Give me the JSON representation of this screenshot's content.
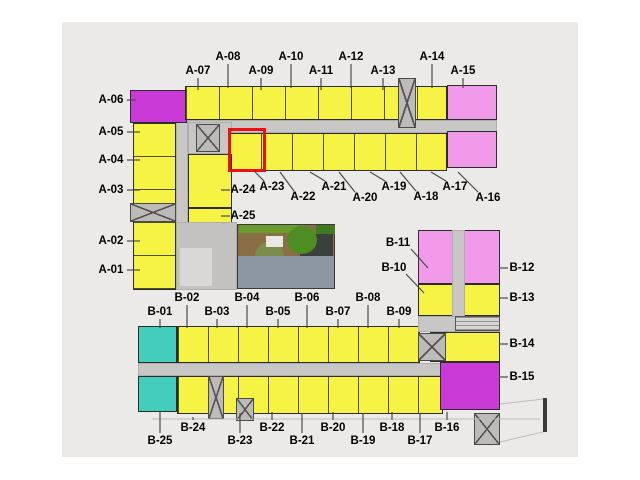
{
  "plan": {
    "selected_unit": "A-23",
    "colors": {
      "yellow": "#f6f344",
      "pink": "#f19ae9",
      "magenta": "#ca3ad6",
      "teal": "#43cdbd",
      "corridor": "#c8c7c5",
      "core": "#bcbbb9",
      "lobby": "#c3c2c0",
      "lobbyLight": "#d9d8d6",
      "service": "#d6d5d3",
      "wallbar": "#3a3a3a",
      "paper": "#ebeae8",
      "highlight": "#ec1111",
      "leader": "#4a4a4a",
      "outline": "#bdbcba",
      "deck": "#8a6e45",
      "green1": "#6a9c2e",
      "green2": "#3f7a1f",
      "tree": "#4e8d21",
      "bush": "#7b8c4d",
      "pavilion": "#3c403c",
      "white": "#e8e8e4",
      "pool": "#8c97a1"
    },
    "blocks": [
      {
        "name": "corridor-a-horizontal",
        "x": 176,
        "y": 120,
        "w": 321,
        "h": 13,
        "color": "corridor",
        "kind": "corridor"
      },
      {
        "name": "corridor-a-vertical",
        "x": 176,
        "y": 120,
        "w": 12,
        "h": 170,
        "color": "corridor",
        "kind": "corridor"
      },
      {
        "name": "entry-core-area",
        "x": 188,
        "y": 122,
        "w": 44,
        "h": 32,
        "color": "corridor",
        "kind": "corridor"
      },
      {
        "name": "unit-block-a06",
        "x": 130,
        "y": 90,
        "w": 57,
        "h": 33,
        "color": "magenta",
        "kind": "unit"
      },
      {
        "name": "unit-column-a05-a01",
        "x": 133,
        "y": 123,
        "w": 43,
        "h": 167,
        "color": "yellow",
        "kind": "unit",
        "tick": "h33"
      },
      {
        "name": "unit-row-a07-a14",
        "x": 185,
        "y": 86,
        "w": 262,
        "h": 34,
        "color": "yellow",
        "kind": "unit",
        "tick": "v33"
      },
      {
        "name": "unit-block-a15",
        "x": 447,
        "y": 85,
        "w": 50,
        "h": 35,
        "color": "pink",
        "kind": "unit"
      },
      {
        "name": "unit-row-a23-a17",
        "x": 229,
        "y": 133,
        "w": 218,
        "h": 38,
        "color": "yellow",
        "kind": "unit",
        "tick": "v31"
      },
      {
        "name": "unit-block-a16",
        "x": 447,
        "y": 131,
        "w": 50,
        "h": 37,
        "color": "pink",
        "kind": "unit"
      },
      {
        "name": "unit-block-a24",
        "x": 188,
        "y": 154,
        "w": 44,
        "h": 54,
        "color": "yellow",
        "kind": "unit"
      },
      {
        "name": "unit-block-a25",
        "x": 188,
        "y": 208,
        "w": 44,
        "h": 44,
        "color": "yellow",
        "kind": "unit"
      },
      {
        "name": "elevator-core-a",
        "x": 196,
        "y": 124,
        "w": 24,
        "h": 28,
        "color": "core",
        "kind": "core"
      },
      {
        "name": "stair-core-top",
        "x": 398,
        "y": 78,
        "w": 18,
        "h": 50,
        "color": "core",
        "kind": "core"
      },
      {
        "name": "stair-core-left",
        "x": 130,
        "y": 203,
        "w": 46,
        "h": 19,
        "color": "core",
        "kind": "core"
      },
      {
        "name": "lobby-area",
        "x": 176,
        "y": 222,
        "w": 61,
        "h": 68,
        "color": "lobby",
        "kind": "corridor"
      },
      {
        "name": "lobby-inner",
        "x": 180,
        "y": 248,
        "w": 32,
        "h": 38,
        "color": "lobbyLight",
        "kind": "decor"
      },
      {
        "name": "unit-block-b01",
        "x": 138,
        "y": 326,
        "w": 39,
        "h": 37,
        "color": "teal",
        "kind": "unit"
      },
      {
        "name": "unit-row-b02-b09",
        "x": 177,
        "y": 326,
        "w": 243,
        "h": 37,
        "color": "yellow",
        "kind": "unit",
        "tick": "v30"
      },
      {
        "name": "corridor-b-horizontal",
        "x": 138,
        "y": 363,
        "w": 327,
        "h": 13,
        "color": "corridor",
        "kind": "corridor"
      },
      {
        "name": "unit-block-b25",
        "x": 138,
        "y": 376,
        "w": 39,
        "h": 36,
        "color": "teal",
        "kind": "unit"
      },
      {
        "name": "unit-row-b24-b16",
        "x": 177,
        "y": 376,
        "w": 266,
        "h": 38,
        "color": "yellow",
        "kind": "unit",
        "tick": "v30"
      },
      {
        "name": "stair-core-b-left",
        "x": 208,
        "y": 376,
        "w": 16,
        "h": 43,
        "color": "core",
        "kind": "core"
      },
      {
        "name": "stair-core-b-mid",
        "x": 236,
        "y": 398,
        "w": 18,
        "h": 23,
        "color": "core",
        "kind": "core"
      },
      {
        "name": "unit-block-b11-b12",
        "x": 418,
        "y": 230,
        "w": 82,
        "h": 54,
        "color": "pink",
        "kind": "unit"
      },
      {
        "name": "unit-block-b10-b13",
        "x": 418,
        "y": 284,
        "w": 82,
        "h": 32,
        "color": "yellow",
        "kind": "unit"
      },
      {
        "name": "corridor-b-vertical",
        "x": 452,
        "y": 230,
        "w": 13,
        "h": 102,
        "color": "corridor",
        "kind": "corridor"
      },
      {
        "name": "corridor-b-right",
        "x": 418,
        "y": 316,
        "w": 82,
        "h": 16,
        "color": "corridor",
        "kind": "corridor"
      },
      {
        "name": "service-room-box",
        "x": 455,
        "y": 316,
        "w": 45,
        "h": 15,
        "color": "service",
        "kind": "service"
      },
      {
        "name": "unit-block-b14",
        "x": 430,
        "y": 332,
        "w": 70,
        "h": 30,
        "color": "yellow",
        "kind": "unit"
      },
      {
        "name": "elevator-core-b",
        "x": 418,
        "y": 333,
        "w": 28,
        "h": 28,
        "color": "core",
        "kind": "core"
      },
      {
        "name": "unit-block-b15",
        "x": 440,
        "y": 362,
        "w": 60,
        "h": 48,
        "color": "magenta",
        "kind": "unit"
      },
      {
        "name": "stair-core-bottom-right",
        "x": 474,
        "y": 413,
        "w": 26,
        "h": 32,
        "color": "core",
        "kind": "core"
      },
      {
        "name": "site-wall-bar",
        "x": 543,
        "y": 398,
        "w": 4,
        "h": 34,
        "color": "wallbar",
        "kind": "decor"
      }
    ],
    "courtyard": {
      "elements": [
        {
          "name": "courtyard-deck",
          "x": 237,
          "y": 224,
          "w": 98,
          "h": 65,
          "color": "deck",
          "border": true
        },
        {
          "name": "hedge-strip",
          "x": 239,
          "y": 225,
          "w": 60,
          "h": 8,
          "color": "green1"
        },
        {
          "name": "hedge-strip-2",
          "x": 316,
          "y": 225,
          "w": 19,
          "h": 10,
          "color": "green2"
        },
        {
          "name": "pool-pavilion",
          "x": 300,
          "y": 234,
          "w": 33,
          "h": 24,
          "color": "pavilion"
        },
        {
          "name": "courtyard-tree",
          "x": 287,
          "y": 226,
          "w": 30,
          "h": 28,
          "color": "tree",
          "round": true
        },
        {
          "name": "courtyard-bush",
          "x": 255,
          "y": 242,
          "w": 29,
          "h": 27,
          "color": "bush",
          "round": true
        },
        {
          "name": "pool-lounger",
          "x": 266,
          "y": 236,
          "w": 17,
          "h": 11,
          "color": "white"
        },
        {
          "name": "swimming-pool",
          "x": 238,
          "y": 256,
          "w": 96,
          "h": 32,
          "color": "pool"
        }
      ]
    },
    "units": [
      {
        "id": "A-01",
        "color": "yellow",
        "x": 111,
        "y": 270,
        "leader": [
          127,
          270,
          140,
          270
        ]
      },
      {
        "id": "A-02",
        "color": "yellow",
        "x": 111,
        "y": 241,
        "leader": [
          127,
          241,
          140,
          241
        ]
      },
      {
        "id": "A-03",
        "color": "yellow",
        "x": 111,
        "y": 190,
        "leader": [
          127,
          190,
          140,
          190
        ]
      },
      {
        "id": "A-04",
        "color": "yellow",
        "x": 111,
        "y": 160,
        "leader": [
          127,
          160,
          140,
          160
        ]
      },
      {
        "id": "A-05",
        "color": "yellow",
        "x": 111,
        "y": 132,
        "leader": [
          127,
          132,
          140,
          132
        ]
      },
      {
        "id": "A-06",
        "color": "magenta",
        "x": 111,
        "y": 100,
        "leader": [
          127,
          100,
          136,
          100
        ]
      },
      {
        "id": "A-07",
        "color": "yellow",
        "x": 198,
        "y": 71,
        "leader": [
          198,
          78,
          198,
          90
        ]
      },
      {
        "id": "A-08",
        "color": "yellow",
        "x": 228,
        "y": 57,
        "leader": [
          228,
          64,
          228,
          88
        ]
      },
      {
        "id": "A-09",
        "color": "yellow",
        "x": 261,
        "y": 71,
        "leader": [
          261,
          78,
          261,
          90
        ]
      },
      {
        "id": "A-10",
        "color": "yellow",
        "x": 291,
        "y": 57,
        "leader": [
          291,
          64,
          291,
          88
        ]
      },
      {
        "id": "A-11",
        "color": "yellow",
        "x": 321,
        "y": 71,
        "leader": [
          321,
          78,
          321,
          90
        ]
      },
      {
        "id": "A-12",
        "color": "yellow",
        "x": 351,
        "y": 57,
        "leader": [
          351,
          64,
          351,
          88
        ]
      },
      {
        "id": "A-13",
        "color": "yellow",
        "x": 383,
        "y": 71,
        "leader": [
          383,
          78,
          383,
          90
        ]
      },
      {
        "id": "A-14",
        "color": "yellow",
        "x": 432,
        "y": 57,
        "leader": [
          432,
          64,
          432,
          88
        ]
      },
      {
        "id": "A-15",
        "color": "pink",
        "x": 463,
        "y": 71,
        "leader": [
          463,
          78,
          463,
          88
        ]
      },
      {
        "id": "A-16",
        "color": "pink",
        "x": 488,
        "y": 198,
        "leader": [
          478,
          192,
          458,
          172
        ]
      },
      {
        "id": "A-17",
        "color": "yellow",
        "x": 455,
        "y": 187,
        "leader": [
          446,
          181,
          431,
          172
        ]
      },
      {
        "id": "A-18",
        "color": "yellow",
        "x": 426,
        "y": 197,
        "leader": [
          416,
          191,
          400,
          172
        ]
      },
      {
        "id": "A-19",
        "color": "yellow",
        "x": 394,
        "y": 187,
        "leader": [
          385,
          181,
          370,
          172
        ]
      },
      {
        "id": "A-20",
        "color": "yellow",
        "x": 365,
        "y": 198,
        "leader": [
          355,
          192,
          339,
          172
        ]
      },
      {
        "id": "A-21",
        "color": "yellow",
        "x": 334,
        "y": 187,
        "leader": [
          325,
          181,
          310,
          172
        ]
      },
      {
        "id": "A-22",
        "color": "yellow",
        "x": 303,
        "y": 197,
        "leader": [
          294,
          191,
          280,
          172
        ]
      },
      {
        "id": "A-23",
        "color": "yellow",
        "x": 272,
        "y": 187,
        "leader": [
          264,
          181,
          255,
          172
        ],
        "selected": true
      },
      {
        "id": "A-24",
        "color": "yellow",
        "x": 243,
        "y": 190,
        "leader": [
          221,
          190,
          230,
          190
        ]
      },
      {
        "id": "A-25",
        "color": "yellow",
        "x": 243,
        "y": 216,
        "leader": [
          221,
          216,
          230,
          216
        ]
      },
      {
        "id": "B-01",
        "color": "teal",
        "x": 160,
        "y": 312,
        "leader": [
          160,
          319,
          160,
          328
        ]
      },
      {
        "id": "B-02",
        "color": "yellow",
        "x": 187,
        "y": 298,
        "leader": [
          187,
          305,
          187,
          328
        ]
      },
      {
        "id": "B-03",
        "color": "yellow",
        "x": 217,
        "y": 312,
        "leader": [
          217,
          319,
          217,
          328
        ]
      },
      {
        "id": "B-04",
        "color": "yellow",
        "x": 247,
        "y": 298,
        "leader": [
          247,
          305,
          247,
          328
        ]
      },
      {
        "id": "B-05",
        "color": "yellow",
        "x": 278,
        "y": 312,
        "leader": [
          278,
          319,
          278,
          328
        ]
      },
      {
        "id": "B-06",
        "color": "yellow",
        "x": 307,
        "y": 298,
        "leader": [
          307,
          305,
          307,
          328
        ]
      },
      {
        "id": "B-07",
        "color": "yellow",
        "x": 338,
        "y": 312,
        "leader": [
          338,
          319,
          338,
          328
        ]
      },
      {
        "id": "B-08",
        "color": "yellow",
        "x": 368,
        "y": 298,
        "leader": [
          368,
          305,
          368,
          328
        ]
      },
      {
        "id": "B-09",
        "color": "yellow",
        "x": 399,
        "y": 312,
        "leader": [
          399,
          319,
          399,
          328
        ]
      },
      {
        "id": "B-10",
        "color": "yellow",
        "x": 394,
        "y": 268,
        "leader": [
          406,
          274,
          424,
          293
        ]
      },
      {
        "id": "B-11",
        "color": "pink",
        "x": 398,
        "y": 243,
        "leader": [
          411,
          249,
          428,
          268
        ]
      },
      {
        "id": "B-12",
        "color": "pink",
        "x": 522,
        "y": 268,
        "leader": [
          508,
          268,
          499,
          268
        ]
      },
      {
        "id": "B-13",
        "color": "yellow",
        "x": 522,
        "y": 298,
        "leader": [
          508,
          298,
          499,
          298
        ]
      },
      {
        "id": "B-14",
        "color": "yellow",
        "x": 522,
        "y": 344,
        "leader": [
          508,
          344,
          499,
          344
        ]
      },
      {
        "id": "B-15",
        "color": "magenta",
        "x": 522,
        "y": 377,
        "leader": [
          508,
          377,
          499,
          377
        ]
      },
      {
        "id": "B-16",
        "color": "yellow",
        "x": 447,
        "y": 428,
        "leader": [
          447,
          420,
          447,
          412
        ]
      },
      {
        "id": "B-17",
        "color": "yellow",
        "x": 420,
        "y": 441,
        "leader": [
          420,
          433,
          420,
          413
        ]
      },
      {
        "id": "B-18",
        "color": "yellow",
        "x": 392,
        "y": 428,
        "leader": [
          392,
          420,
          392,
          412
        ]
      },
      {
        "id": "B-19",
        "color": "yellow",
        "x": 363,
        "y": 441,
        "leader": [
          363,
          433,
          363,
          413
        ]
      },
      {
        "id": "B-20",
        "color": "yellow",
        "x": 333,
        "y": 428,
        "leader": [
          333,
          420,
          333,
          412
        ]
      },
      {
        "id": "B-21",
        "color": "yellow",
        "x": 302,
        "y": 441,
        "leader": [
          302,
          433,
          302,
          413
        ]
      },
      {
        "id": "B-22",
        "color": "yellow",
        "x": 272,
        "y": 428,
        "leader": [
          272,
          420,
          272,
          412
        ]
      },
      {
        "id": "B-23",
        "color": "yellow",
        "x": 240,
        "y": 441,
        "leader": [
          240,
          433,
          240,
          413
        ]
      },
      {
        "id": "B-24",
        "color": "yellow",
        "x": 193,
        "y": 428,
        "leader": [
          193,
          420,
          193,
          417
        ]
      },
      {
        "id": "B-25",
        "color": "teal",
        "x": 160,
        "y": 441,
        "leader": [
          160,
          433,
          160,
          411
        ]
      }
    ],
    "outlines": [
      [
        152,
        419,
        540,
        419
      ],
      [
        500,
        404,
        543,
        399
      ],
      [
        500,
        442,
        543,
        432
      ]
    ],
    "highlight": {
      "x": 228,
      "y": 128,
      "w": 38,
      "h": 44
    }
  }
}
